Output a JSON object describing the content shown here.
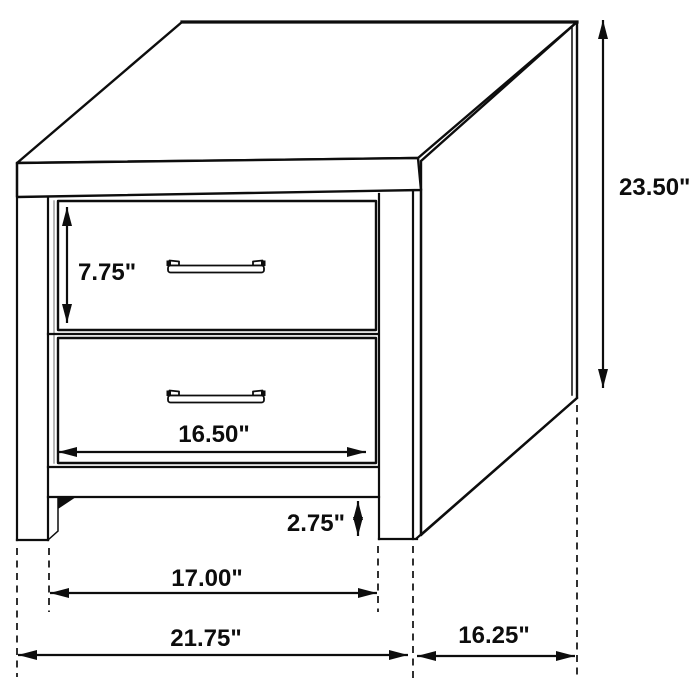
{
  "diagram": {
    "item": "two-drawer-nightstand",
    "drawer_count": 2,
    "line_color": "#0d0d0d",
    "background_color": "#ffffff",
    "labels": {
      "overall_height": "23.50\"",
      "drawer_front_height": "7.75\"",
      "drawer_front_width": "16.50\"",
      "base_clearance": "2.75\"",
      "width_between_legs": "17.00\"",
      "overall_width": "21.75\"",
      "side_depth": "16.25\""
    }
  }
}
